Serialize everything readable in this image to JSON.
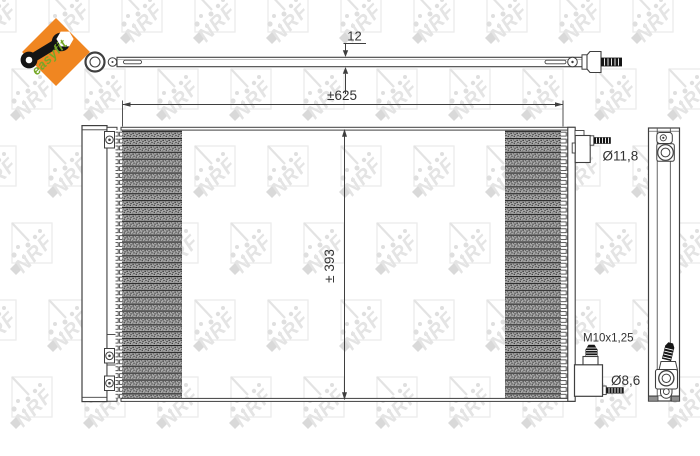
{
  "branding": {
    "easyfit_label": "easyfit",
    "watermark_text": "NRF",
    "colors": {
      "diamond_orange": "#f08621",
      "easyfit_green": "#76a828",
      "watermark_gray": "#e7e7e7",
      "line_dark": "#3f3f3f"
    }
  },
  "drawing": {
    "labels": {
      "bar_thickness": "12",
      "overall_width": "±625",
      "overall_height": "± 393",
      "top_connection_diameter": "Ø11,8",
      "thread_spec": "M10x1,25",
      "bottom_connection_diameter": "Ø8,6"
    }
  }
}
